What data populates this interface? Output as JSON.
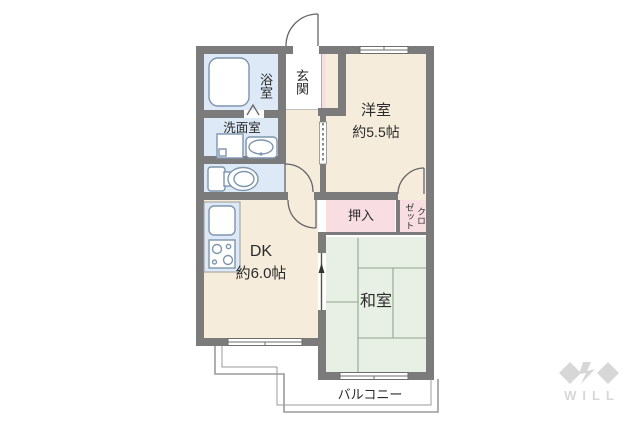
{
  "floorplan": {
    "title_hint": "2DK apartment floor plan",
    "rooms": {
      "bath": {
        "label": "浴室"
      },
      "washroom": {
        "label": "洗面室"
      },
      "toilet": {
        "label": ""
      },
      "entrance": {
        "label": "玄関"
      },
      "western_room": {
        "label": "洋室",
        "size": "約5.5帖"
      },
      "oshiire": {
        "label": "押入"
      },
      "closet": {
        "label": "クロ\nゼット"
      },
      "dk": {
        "label": "DK",
        "size": "約6.0帖"
      },
      "japanese_room": {
        "label": "和室"
      },
      "balcony": {
        "label": "バルコニー"
      }
    },
    "fixtures": [
      "bathtub-icon",
      "washing-machine-icon",
      "washbasin-icon",
      "toilet-icon",
      "kitchen-sink-icon",
      "gas-stove-icon"
    ],
    "door_symbols": [
      "entrance-swing-door",
      "hall-dk-swing-door",
      "toilet-swing-door",
      "closet-swing-door",
      "hall-west-sliding-door",
      "dk-japanese-sliding-door",
      "bath-folding-door"
    ],
    "window_symbols": [
      "western-room-top-window",
      "dk-bottom-window",
      "japanese-room-bottom-window"
    ]
  },
  "watermark": {
    "brand": "WILL"
  },
  "palette": {
    "wall": "#7b7b7b",
    "beige": "#f5ecdc",
    "wet": "#dde9f6",
    "pink": "#f8dde3",
    "green": "#e8efe4",
    "ink": "#2b2b2b",
    "fix": "#7d95ad",
    "line": "#666666",
    "tatami": "#93a393",
    "bal": "#9b9b9b",
    "logo": "#d7d7d7"
  }
}
